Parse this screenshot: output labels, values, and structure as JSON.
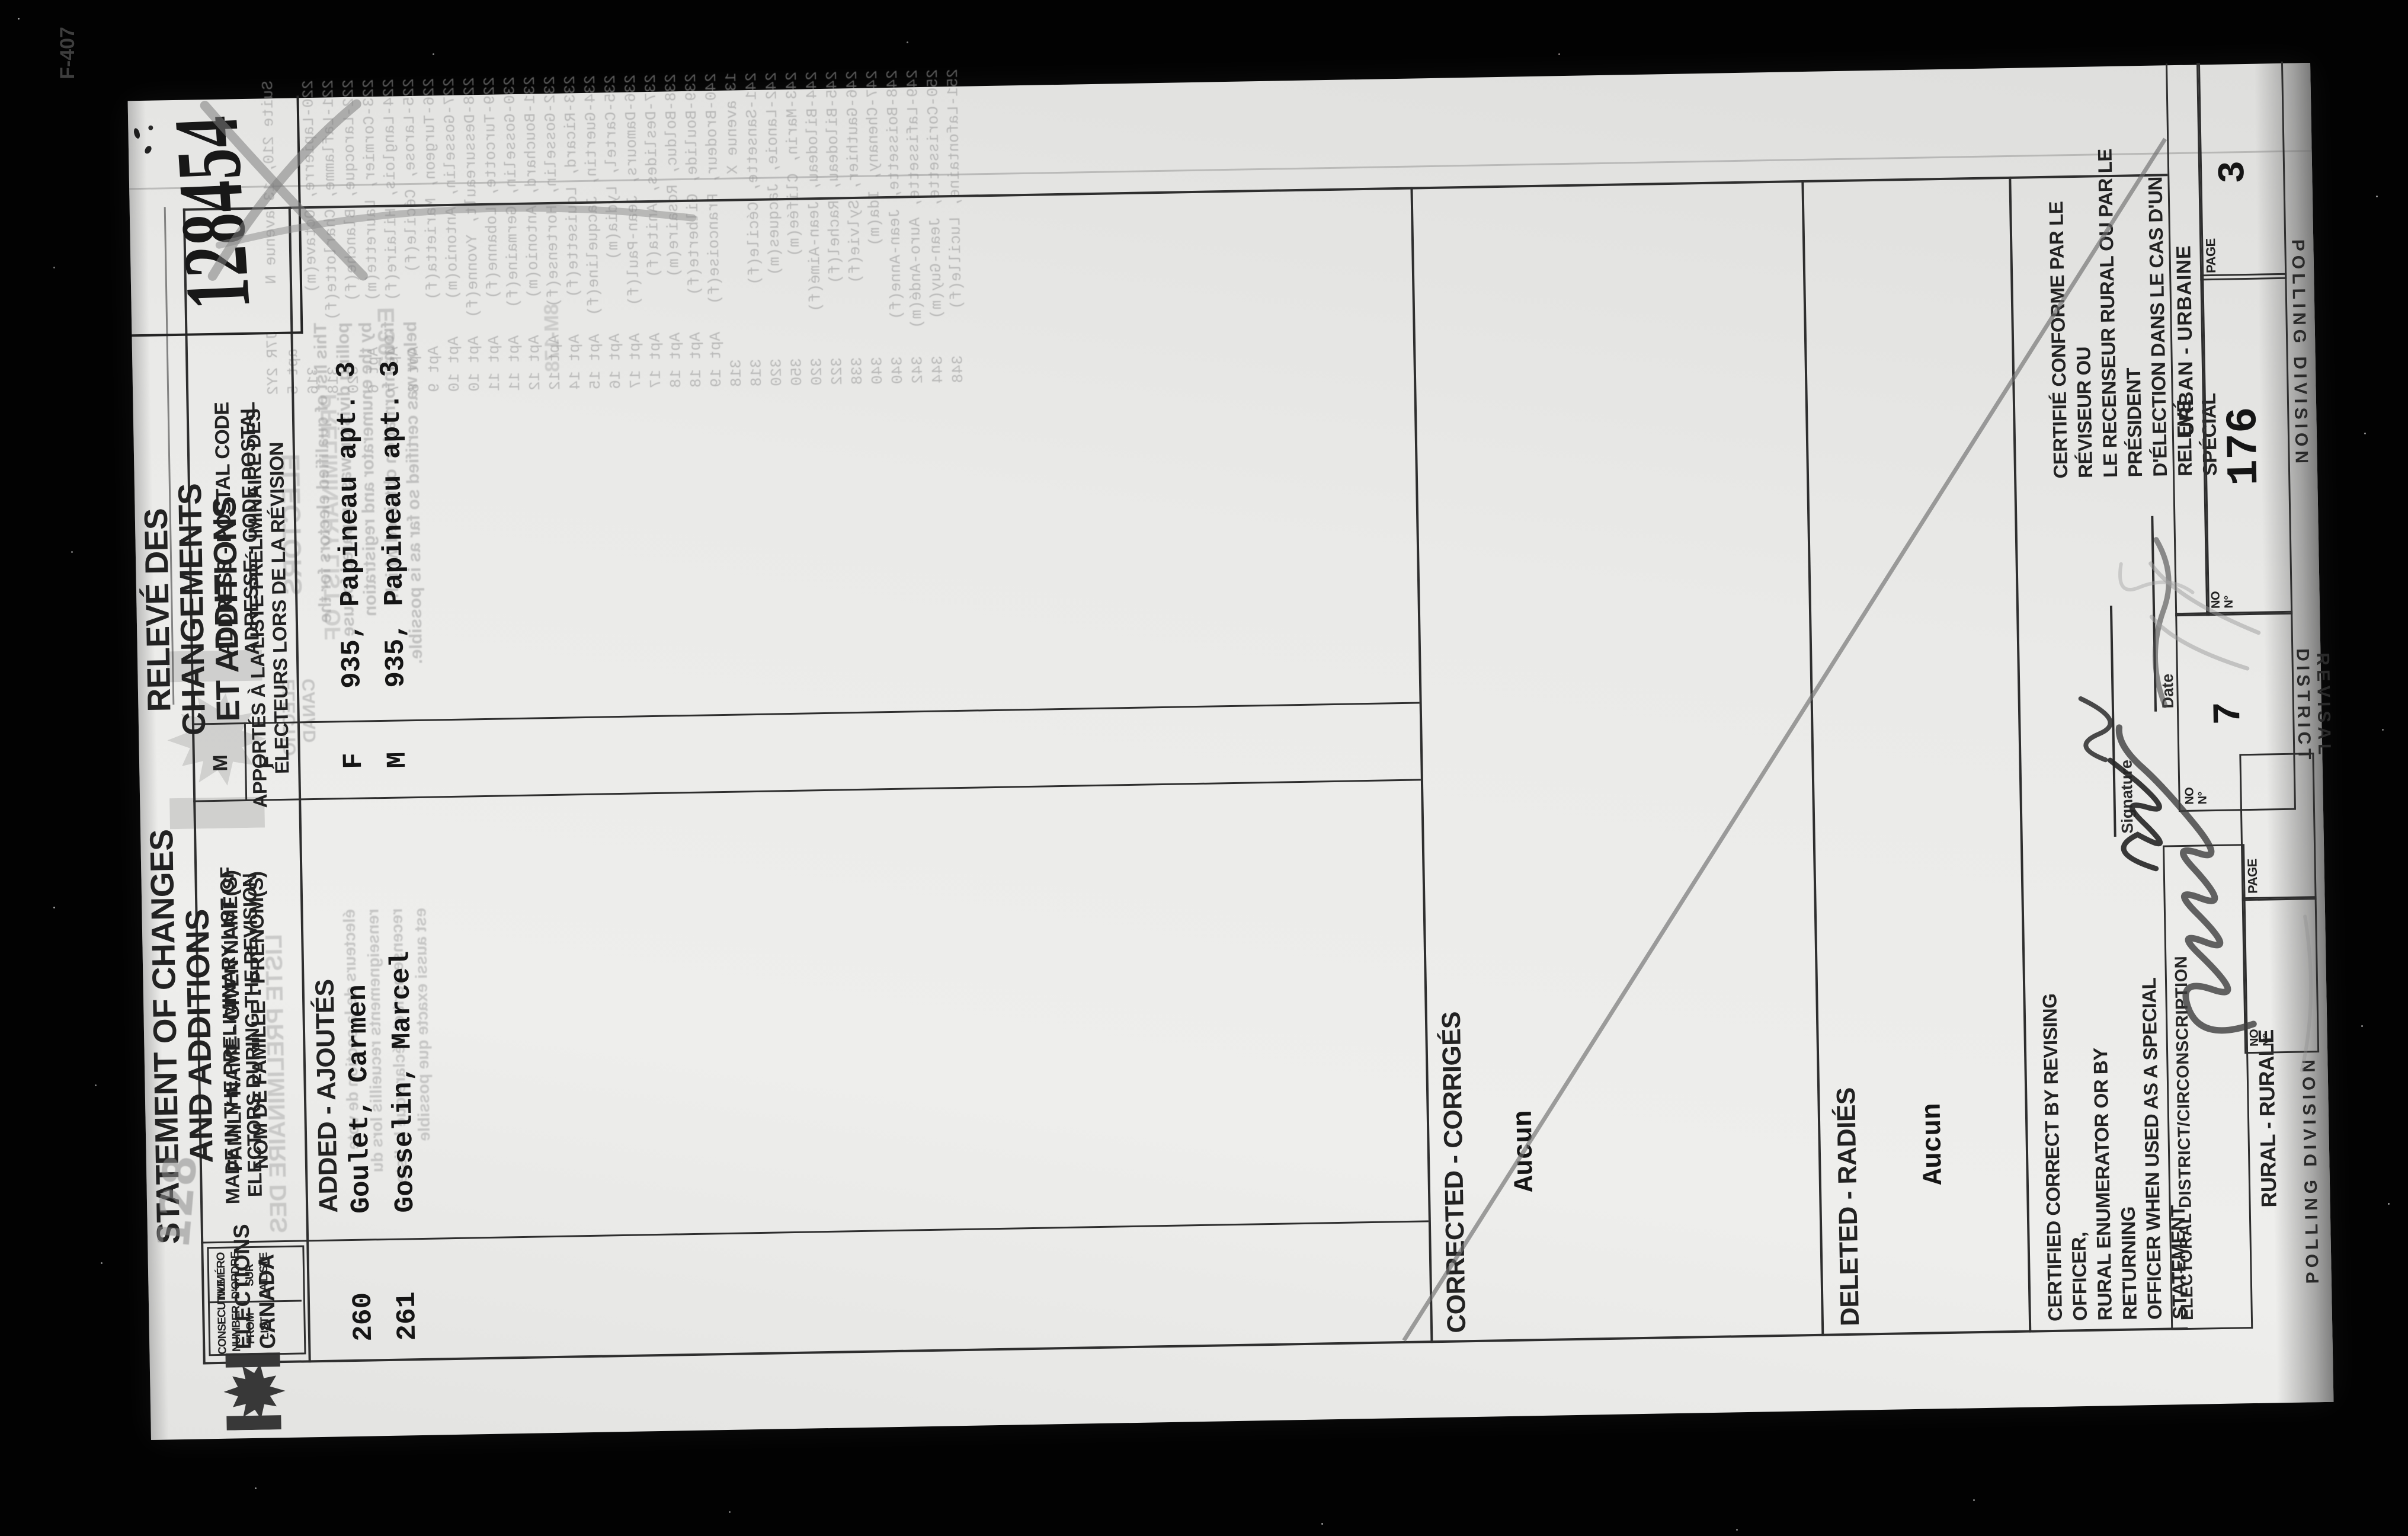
{
  "stamp": {
    "number": "128454",
    "corner_mark": "F-407"
  },
  "titles": {
    "en": {
      "line1": "STATEMENT OF CHANGES",
      "line2": "AND ADDITIONS",
      "sub": "MADE IN THE PRELIMINARY LIST OF\nELECTORS DURING THE REVISION"
    },
    "fr": {
      "line1": "RELEVÉ DES CHANGEMENTS",
      "line2": "ET ADDITIONS",
      "sub": "APPORTÉS À LA LISTE PRÉLIMINAIRE DES\nÉLECTEURS LORS DE LA RÉVISION"
    }
  },
  "agency": {
    "name": "ELECTIONS\nCANADA"
  },
  "table": {
    "headers": {
      "consecutive_en": "CONSECUTIVE\nNUMBER\nFROM LIST",
      "consecutive_fr": "NUMÉRO\nD'ORDRE SUR\nLA LISTE",
      "name": "FAMILY NAME - GIVEN NAME(S)\nNOM DE FAMILLE - PRÉNOM(S)",
      "sex_m": "M",
      "sex_f": "F",
      "address": "ADDRESS - POSTAL CODE\nADRESSE - CODE POSTAL"
    },
    "section_added": "ADDED - AJOUTÉS",
    "rows": [
      {
        "number": "260",
        "name": "Goulet, Carmen",
        "sex": "F",
        "address": "935, Papineau apt. 3"
      },
      {
        "number": "261",
        "name": "Gosselin, Marcel",
        "sex": "M",
        "address": "935, Papineau apt. 3"
      }
    ],
    "section_corrected": "CORRECTED - CORRIGÉS",
    "corrected_value": "Aucun",
    "section_deleted": "DELETED - RADIÉS",
    "deleted_value": "Aucun"
  },
  "handwriting": {
    "pencil_number": "128"
  },
  "certification": {
    "en": "CERTIFIED CORRECT BY REVISING OFFICER,\nRURAL ENUMERATOR OR BY RETURNING\nOFFICER  WHEN  USED  AS  A  SPECIAL\nSTATEMENT",
    "fr": "CERTIFIÉ CONFORME PAR LE RÉVISEUR OU\nLE RECENSEUR RURAL OU PAR LE PRÉSIDENT\nD'ÉLECTION  DANS  LE  CAS  D'UN  RELEVÉ\nSPÉCIAL",
    "signature_label": "Signature",
    "date_label": "Date"
  },
  "footer": {
    "electoral_district_label": "ELECTORAL DISTRICT/CIRCONSCRIPTION",
    "rural_label": "RURAL - RURALE",
    "urban_label": "URBAN - URBAINE",
    "page_label": "PAGE",
    "no_label": "NO\nN°",
    "revisal_district_label": "REVISAL DISTRICT",
    "polling_division_label": "POLLING DIVISION",
    "revisal_district_no": "7",
    "polling_division_no": "176",
    "page_number": "3"
  },
  "bleedthrough": {
    "caps_fr": "LISTE PRÉLIMINAIRE DES",
    "caps_en1": "ELECTORS",
    "caps_en2": "PRELIMINARY LIST OF",
    "logo_text": "ELECTIO\nCANAD",
    "mark1": "E 303",
    "mark2": "8M-178",
    "para_en": "This list of qualified electors for the\npolling division was prepared for use\nby the enumerator and registration\nfrom information obtained which\nbelow was certified so far as is possible.",
    "para_fr": "électeurs de la section de vote\nrenseignements recueillis lors du\nrecensement et déclare que la liste\nest aussi exacte que possible",
    "list_lines": [
      "Suite 210, 13 avenue N     J7R 2Y2",
      "                             apt 5",
      "220-Lapierre, Octave(m)        316",
      "221-Laflamme, Charlotte(f)     318",
      "222-Larocque, Blanche(f)       320",
      "223-Cormier, Laurette(m)     Apt 6",
      "224-Langlois, Hilaire(f)     Apt 7",
      "225-Larose, Cécile(f)        Apt 8",
      "226-Turgeon, Marietta(f)     Apt 9",
      "227-Gosselin, Antonio(m)    Apt 10",
      "228-Dessureault, Yvonne(f)  Apt 10",
      "229-Turcotte, Lobanne(f)    Apt 11",
      "230-Gosselin, Germaine(f)   Apt 11",
      "231-Bouchard, Antonio(m)    Apt 12",
      "232-Gosselin, Hortense(f)   Apt 12",
      "233-Ricard, Louisette(f)    Apt 14",
      "234-Guertin, Jacqueline(f)  Apt 15",
      "235-Cartel, Lydia(m)        Apt 16",
      "236-Damours, Jean-Paul(f)   Apt 17",
      "237-Deslides, Anita(f)      Apt 17",
      "238-Bolduc, Rosaire(m)      Apt 18",
      "239-Boulide, Gilberte(f)    Apt 18",
      "240-Brodeur, Francoise(f)   Apt 19",
      "13 avenue X                    318",
      "241-Sansette, Cécile(f)        318",
      "242-Lanoie, Jacques(m)         320",
      "243-Marin, Clifée(m)           350",
      "244-Bilodeau, Jean-Aimé(f)     320",
      "245-Bilodeau, Rachel(f)        322",
      "246-Gauthier, Sylvie(f)        338",
      "247-Chenany, Ida(m)            340",
      "248-Boissette, Jean-Anne(f)    340",
      "249-Lafissette, Auro-Andé(m)   342",
      "250-Corissette, Jean-Guy(m)    344",
      "251-Lafontaine, Lucille(f)     348"
    ]
  }
}
